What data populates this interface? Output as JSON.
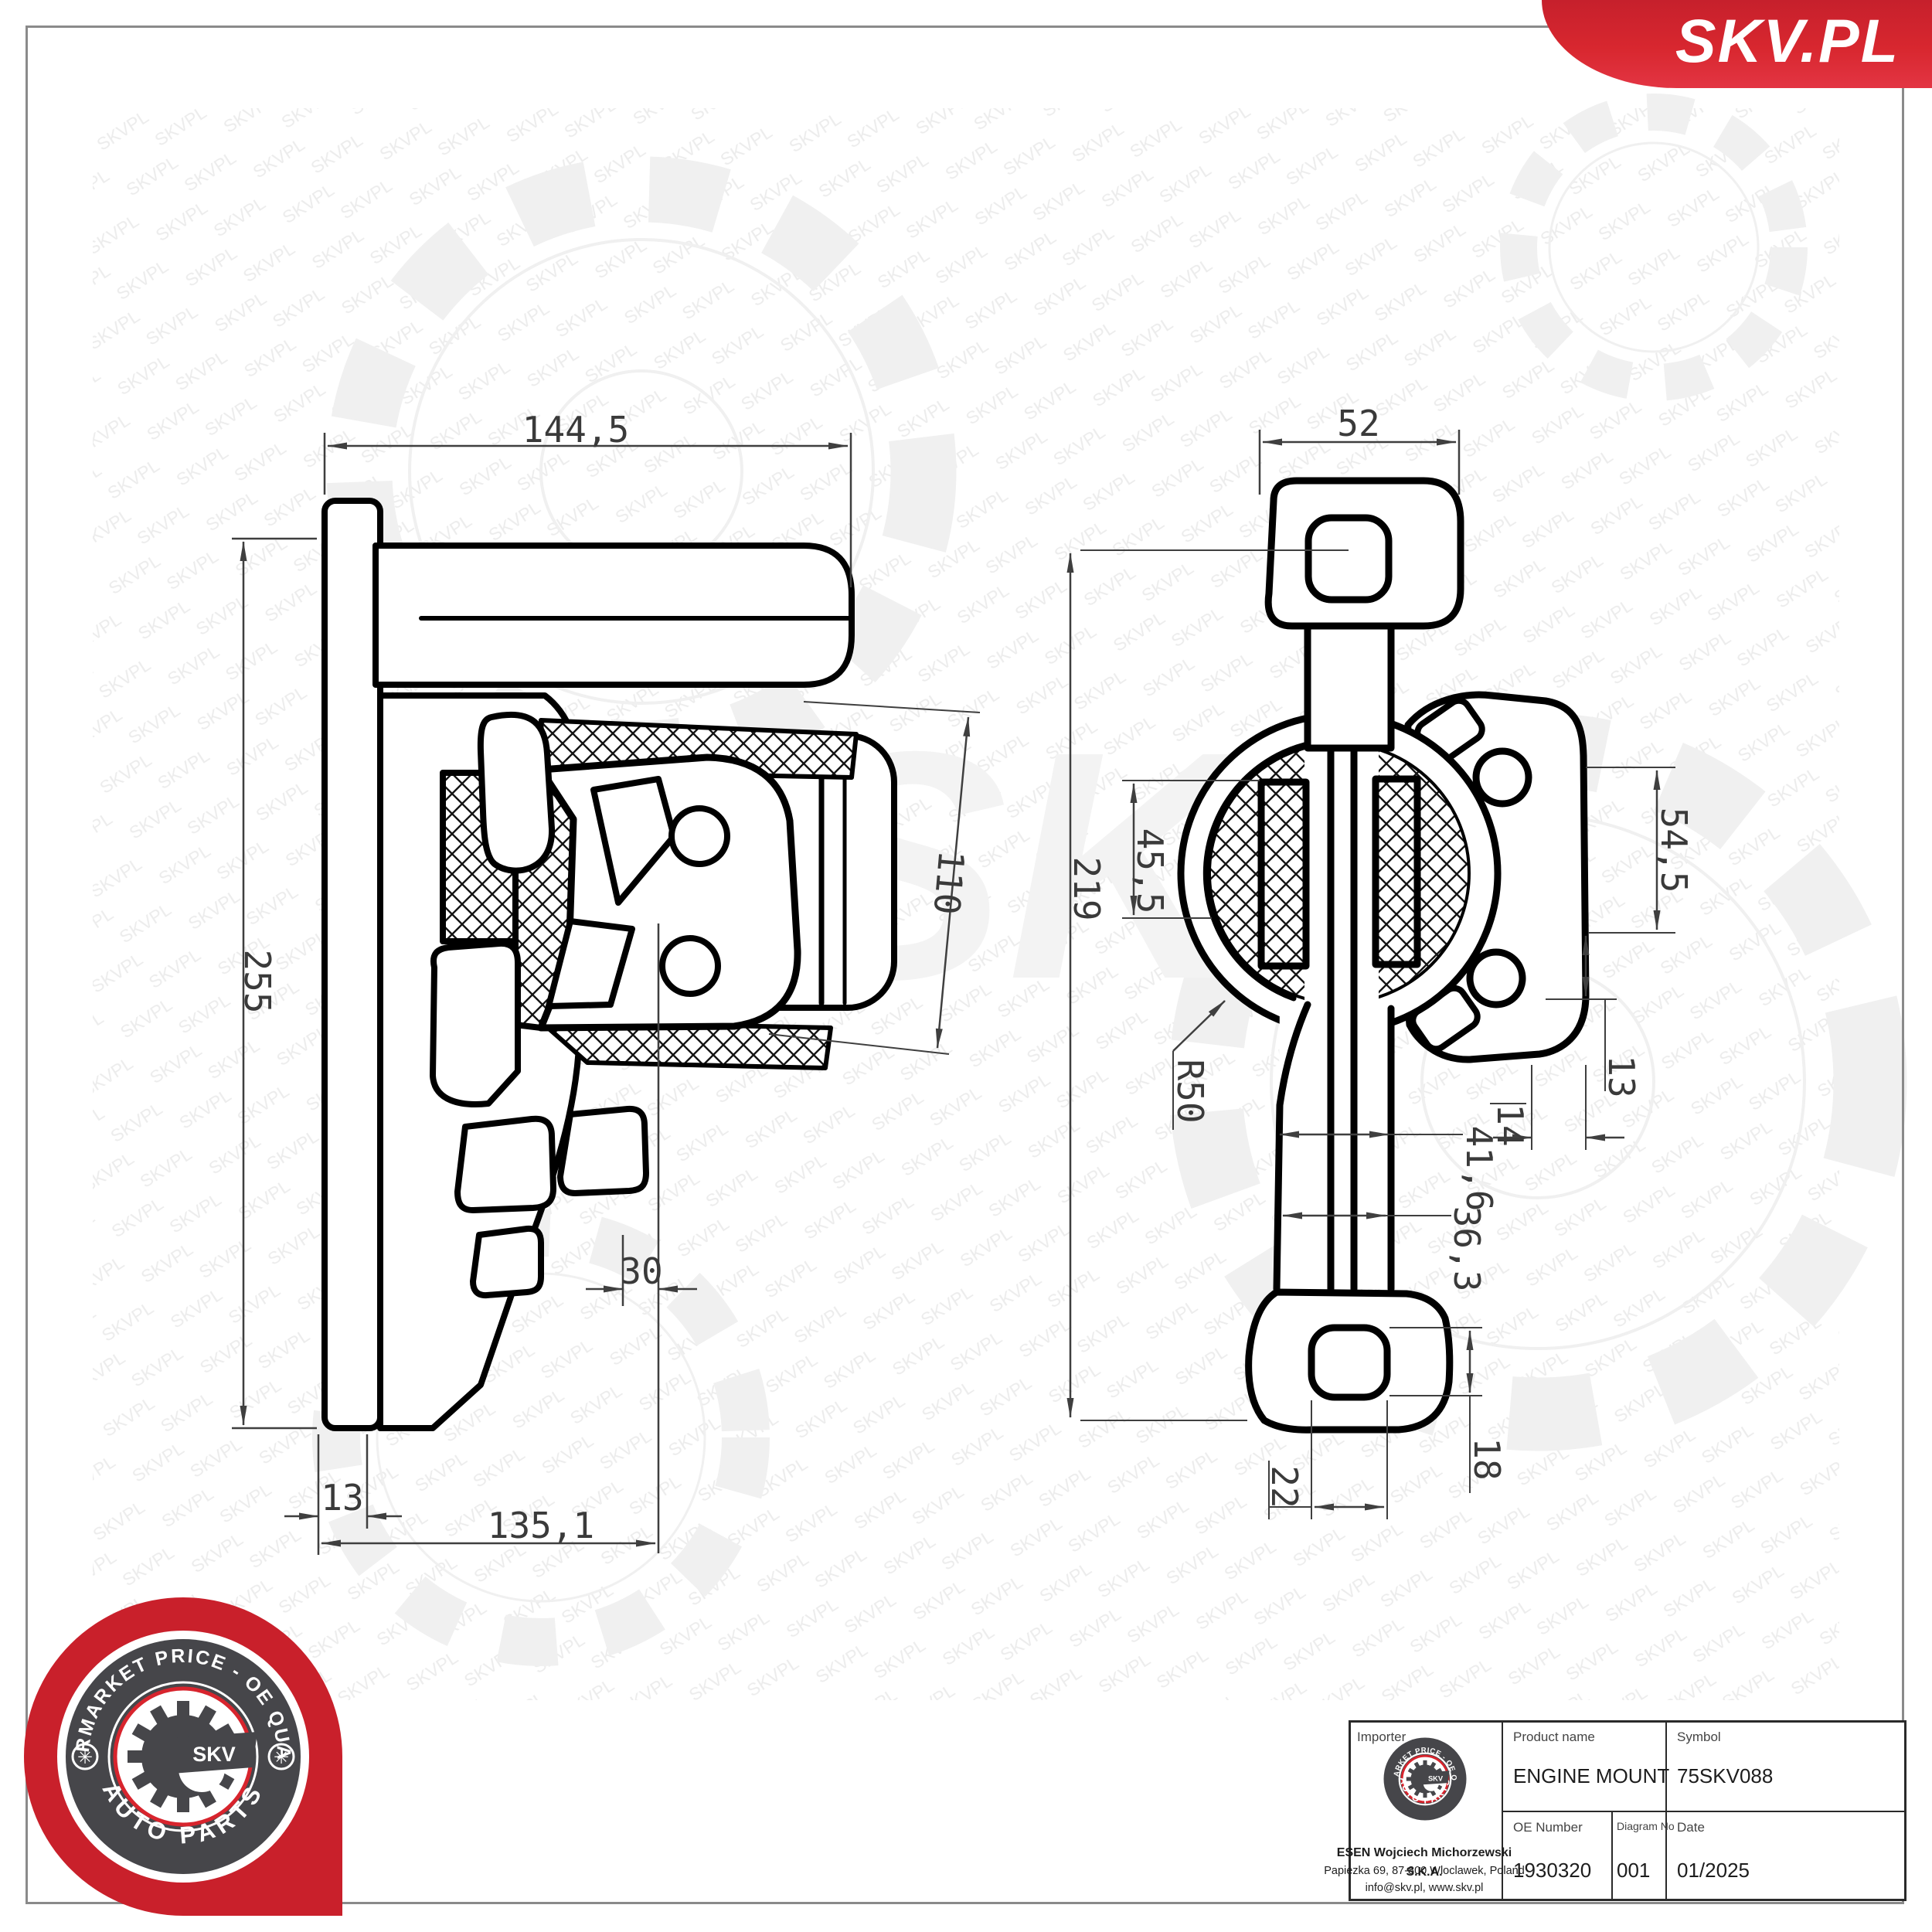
{
  "page": {
    "background": "#ffffff",
    "frame_color": "#8a8a8a"
  },
  "banner": {
    "text": "SKV.PL",
    "color_top": "#c6202c",
    "color_bottom": "#e33543"
  },
  "watermark": {
    "tile_text": "SKVPL",
    "big_text": "SKV"
  },
  "badge": {
    "arc_top": "AFTERMARKET PRICE - OE QUALITY",
    "arc_bottom": "AUTO PARTS",
    "center_text": "SKV",
    "red": "#c9202b",
    "dark": "#46464a",
    "ring_red": "#d8242d"
  },
  "side_view": {
    "dims": {
      "overall_width": "144,5",
      "overall_height": "255",
      "insert_height": "110",
      "insert_offset": "30",
      "plate_thickness": "13",
      "base_length": "135,1"
    }
  },
  "front_view": {
    "dims": {
      "top_width": "52",
      "overall_height": "219",
      "rubber_height": "45,5",
      "flange_hole_spacing": "54,5",
      "radius": "R50",
      "hole_offset": "13",
      "web_offset": "14",
      "arm_outer_width": "41,6",
      "arm_inner_width": "36,3",
      "lug_hole_height": "18",
      "lug_hole_width": "22"
    }
  },
  "title_block": {
    "importer_label": "Importer",
    "importer_name": "ESEN Wojciech Michorzewski S.K.A.",
    "importer_address": "Papiezka 69, 87-800 Wloclawek, Poland",
    "importer_contact": "info@skv.pl, www.skv.pl",
    "product_label": "Product name",
    "product_value": "ENGINE MOUNT",
    "symbol_label": "Symbol",
    "symbol_value": "75SKV088",
    "oe_label": "OE Number",
    "oe_value": "1930320",
    "diagram_label": "Diagram No",
    "diagram_value": "001",
    "date_label": "Date",
    "date_value": "01/2025"
  }
}
